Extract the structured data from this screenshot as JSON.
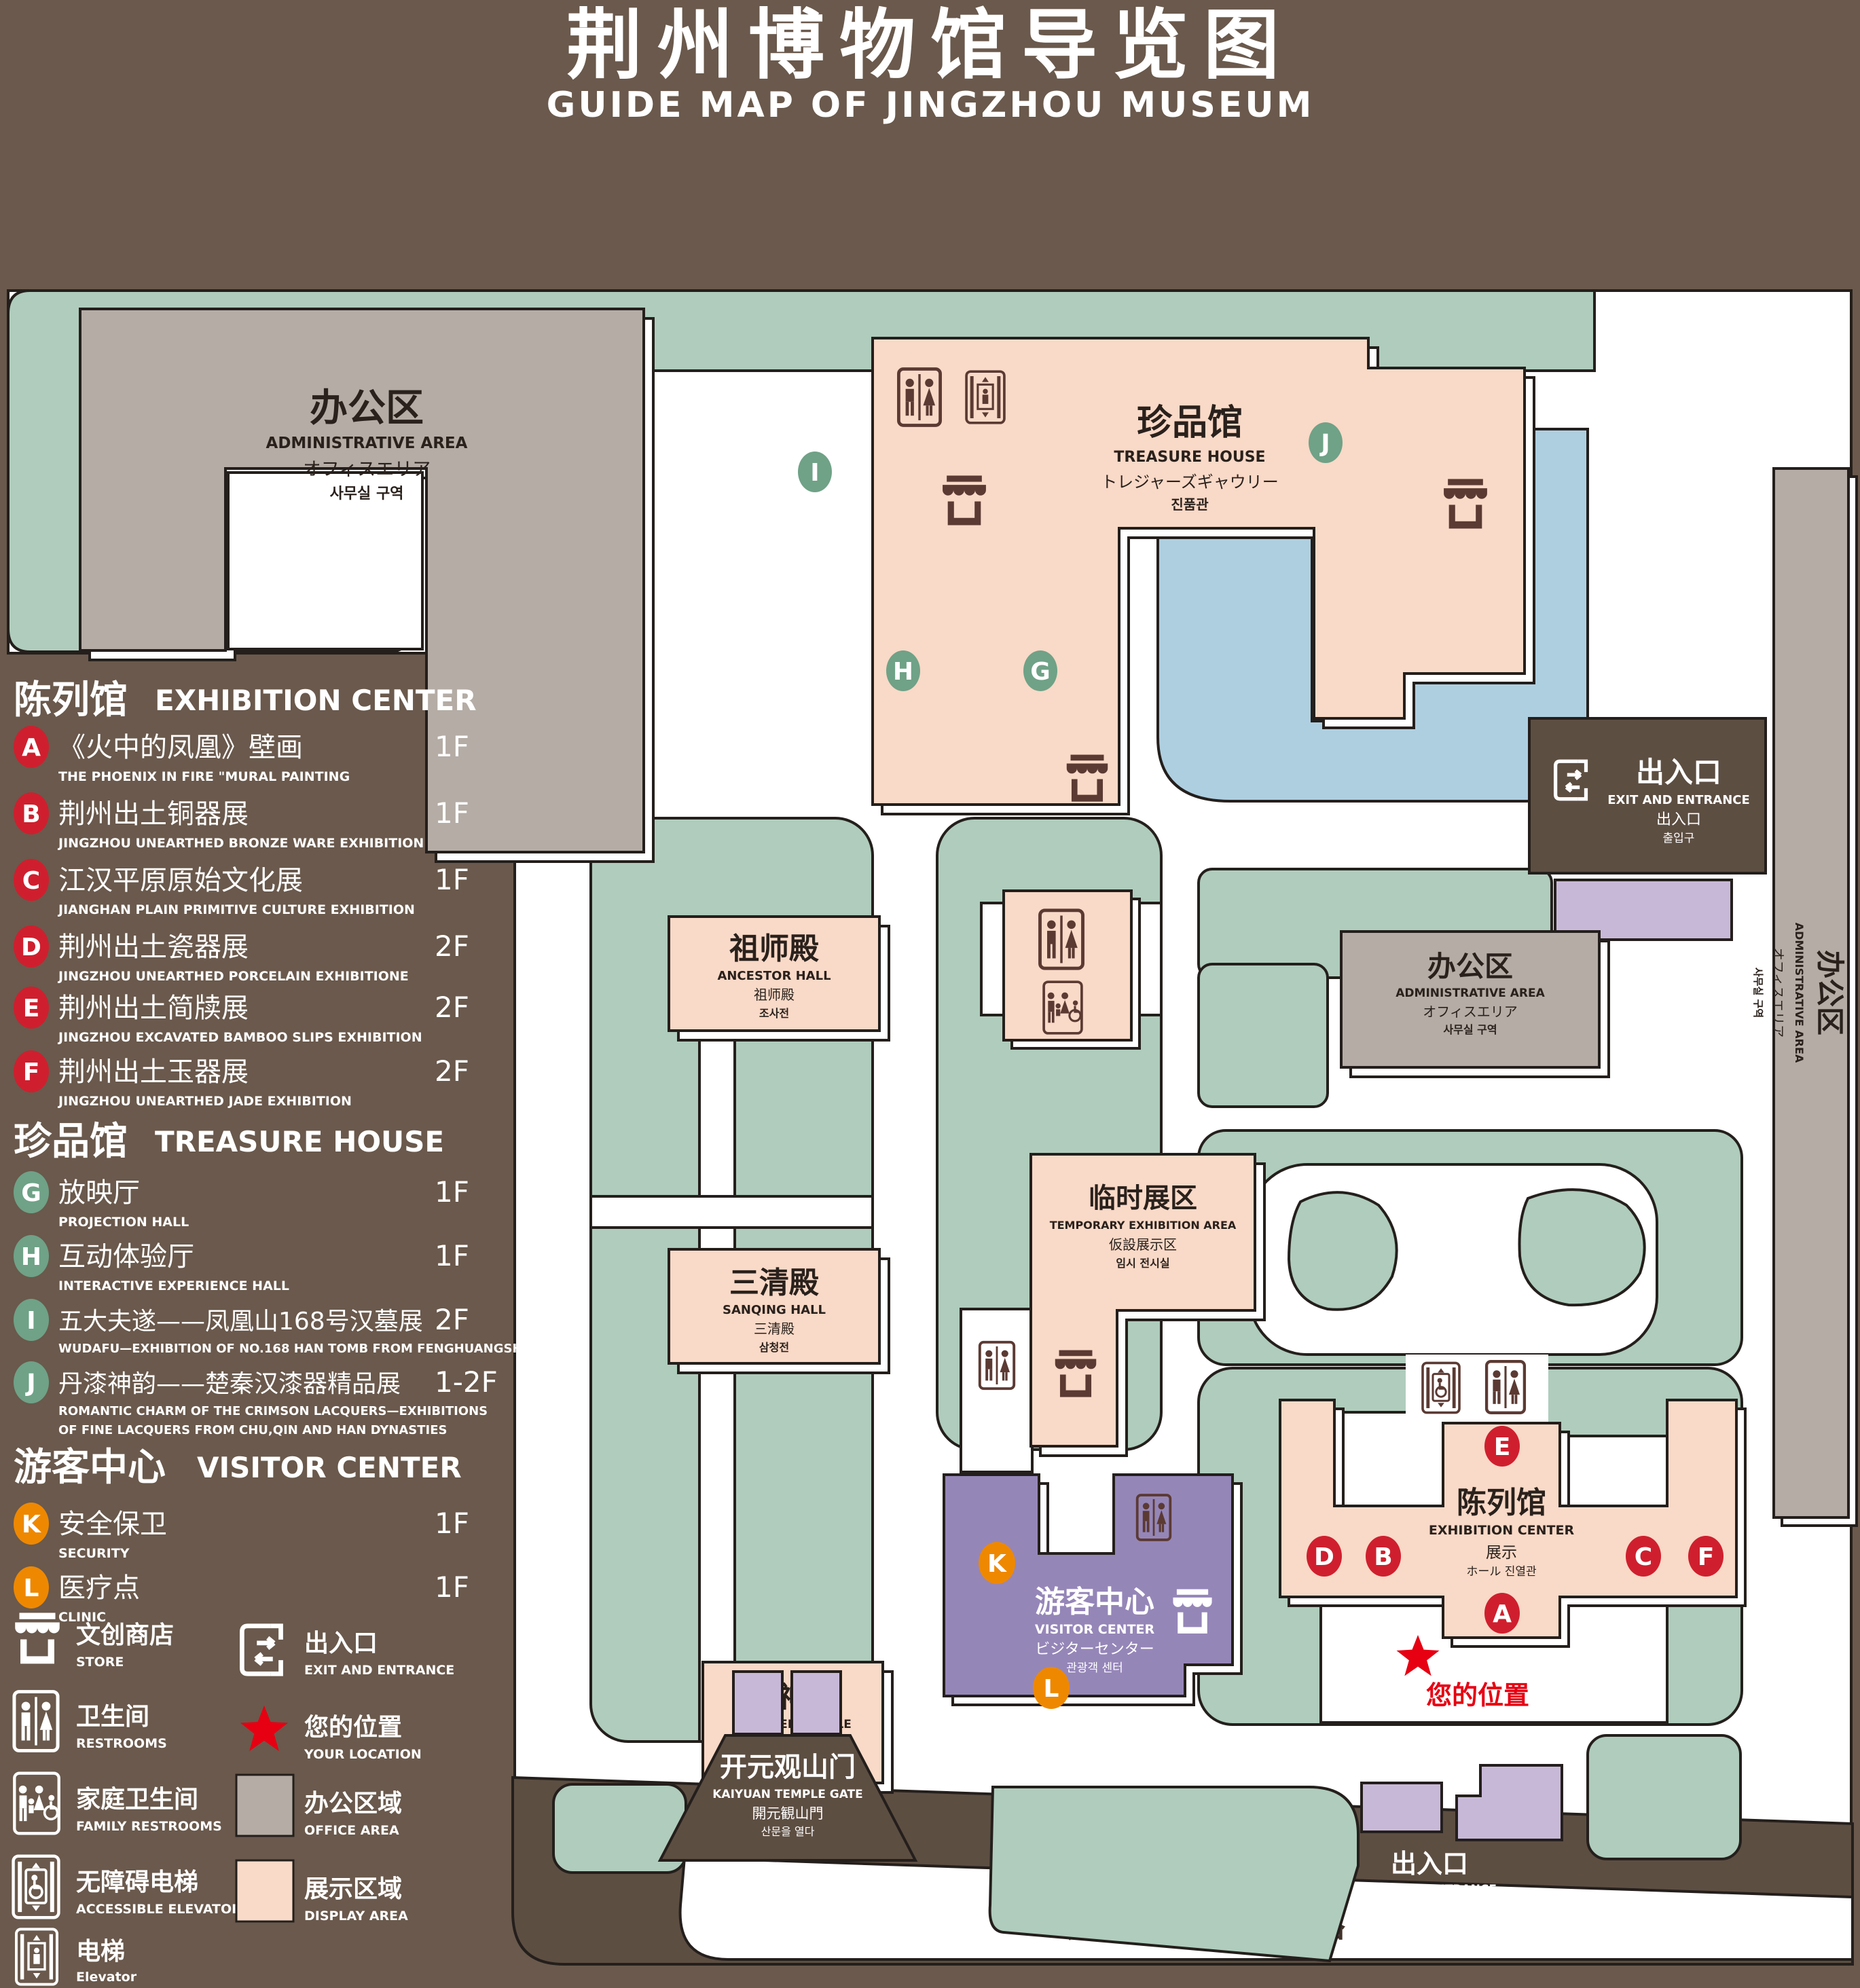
{
  "title": {
    "main": "荆州博物馆导览图",
    "sub": "GUIDE MAP OF JINGZHOU MUSEUM"
  },
  "sidebar": {
    "sections": [
      {
        "cn": "陈列馆",
        "en": "EXHIBITION CENTER",
        "items": [
          {
            "letter": "A",
            "cn": "《火中的凤凰》壁画",
            "en": "THE PHOENIX IN FIRE \"MURAL PAINTING",
            "floor": "1F"
          },
          {
            "letter": "B",
            "cn": "荆州出土铜器展",
            "en": "JINGZHOU UNEARTHED BRONZE WARE EXHIBITION",
            "floor": "1F"
          },
          {
            "letter": "C",
            "cn": "江汉平原原始文化展",
            "en": "JIANGHAN PLAIN PRIMITIVE CULTURE EXHIBITION",
            "floor": "1F"
          },
          {
            "letter": "D",
            "cn": "荆州出土瓷器展",
            "en": "JINGZHOU UNEARTHED PORCELAIN EXHIBITIONE",
            "floor": "2F"
          },
          {
            "letter": "E",
            "cn": "荆州出土简牍展",
            "en": "JINGZHOU EXCAVATED BAMBOO SLIPS EXHIBITION",
            "floor": "2F"
          },
          {
            "letter": "F",
            "cn": "荆州出土玉器展",
            "en": "JINGZHOU UNEARTHED JADE EXHIBITION",
            "floor": "2F"
          }
        ]
      },
      {
        "cn": "珍品馆",
        "en": "TREASURE HOUSE",
        "items": [
          {
            "letter": "G",
            "cn": "放映厅",
            "en": "PROJECTION HALL",
            "floor": "1F"
          },
          {
            "letter": "H",
            "cn": "互动体验厅",
            "en": "INTERACTIVE EXPERIENCE HALL",
            "floor": "1F"
          },
          {
            "letter": "I",
            "cn": "五大夫遂——凤凰山168号汉墓展",
            "en": "WUDAFU—EXHIBITION OF NO.168 HAN TOMB FROM FENGHUANGSHAN",
            "floor": "2F"
          },
          {
            "letter": "J",
            "cn": "丹漆神韵——楚秦汉漆器精品展",
            "en": "ROMANTIC CHARM OF THE CRIMSON LACQUERS—EXHIBITIONS",
            "en2": "OF FINE LACQUERS FROM CHU,QIN AND HAN DYNASTIES",
            "floor": "1-2F"
          }
        ]
      },
      {
        "cn": "游客中心",
        "en": "VISITOR CENTER",
        "items": [
          {
            "letter": "K",
            "cn": "安全保卫",
            "en": "SECURITY",
            "floor": "1F"
          },
          {
            "letter": "L",
            "cn": "医疗点",
            "en": "CLINIC",
            "floor": "1F"
          }
        ]
      }
    ],
    "legend": [
      {
        "cn": "文创商店",
        "en": "STORE"
      },
      {
        "cn": "出入口",
        "en": "EXIT AND ENTRANCE"
      },
      {
        "cn": "卫生间",
        "en": "RESTROOMS"
      },
      {
        "cn": "您的位置",
        "en": "YOUR LOCATION"
      },
      {
        "cn": "家庭卫生间",
        "en": "FAMILY RESTROOMS"
      },
      {
        "cn": "办公区域",
        "en": "OFFICE AREA"
      },
      {
        "cn": "无障碍电梯",
        "en": "ACCESSIBLE ELEVATOR"
      },
      {
        "cn": "展示区域",
        "en": "DISPLAY AREA"
      },
      {
        "cn": "电梯",
        "en": "Elevator"
      }
    ]
  },
  "map": {
    "admin_nw": {
      "cn": "办公区",
      "en": "ADMINISTRATIVE AREA",
      "l3": "オフィスエリア",
      "l4": "사무실 구역"
    },
    "treasure": {
      "cn": "珍品馆",
      "en": "TREASURE HOUSE",
      "l3": "トレジャーズギャウリー",
      "l4": "진품관"
    },
    "ancestor": {
      "cn": "祖师殿",
      "en": "ANCESTOR HALL",
      "l3": "祖师殿",
      "l4": "조사전"
    },
    "sanqing": {
      "cn": "三清殿",
      "en": "SANQING HALL",
      "l3": "三清殿",
      "l4": "삼청전"
    },
    "thunder": {
      "cn": "雷神殿",
      "en": "THUNDER TEMPLE",
      "l3": "雷神殿",
      "l4": "뇌신전"
    },
    "temporary": {
      "cn": "临时展区",
      "en": "TEMPORARY EXHIBITION AREA",
      "l3": "仮設展示区",
      "l4": "임시 전시실"
    },
    "visitor": {
      "cn": "游客中心",
      "en": "VISITOR CENTER",
      "l3": "ビジターセンター",
      "l4": "관광객 센터"
    },
    "admin_c": {
      "cn": "办公区",
      "en": "ADMINISTRATIVE AREA",
      "l3": "オフィスエリア",
      "l4": "사무실 구역"
    },
    "admin_e": {
      "cn": "办公区",
      "en": "ADMINISTRATIVE AREA",
      "l3": "オフィスエリア",
      "l4": "사무실 구역"
    },
    "exhibition": {
      "cn": "陈列馆",
      "en": "EXHIBITION CENTER",
      "l3": "展示",
      "l4": "ホール 진열관"
    },
    "exit_ne": {
      "cn": "出入口",
      "en": "EXIT AND ENTRANCE",
      "l3": "出入口",
      "l4": "출입구"
    },
    "exit_s": {
      "cn": "出入口",
      "en": "EXIT AND ENTRANCE",
      "l3": "出入口",
      "l4": "출입구"
    },
    "gate": {
      "cn": "开元观山门",
      "en": "KAIYUAN TEMPLE GATE",
      "l3": "開元観山門",
      "l4": "산문을 열다"
    },
    "road": "荆 州 中 路",
    "your_location": "您的位置"
  },
  "colors": {
    "background": "#6a594c",
    "lawn": "#afccbc",
    "display_area": "#f9d9c7",
    "office_area": "#b4aca5",
    "visitor_center": "#9586b8",
    "gate_purple": "#c8b8d8",
    "pond": "#aecfe0",
    "road_brown": "#5d4e42",
    "marker_red": "#cf1f2e",
    "marker_green": "#6fa287",
    "marker_orange": "#ee8800",
    "star_red": "#e60012"
  }
}
